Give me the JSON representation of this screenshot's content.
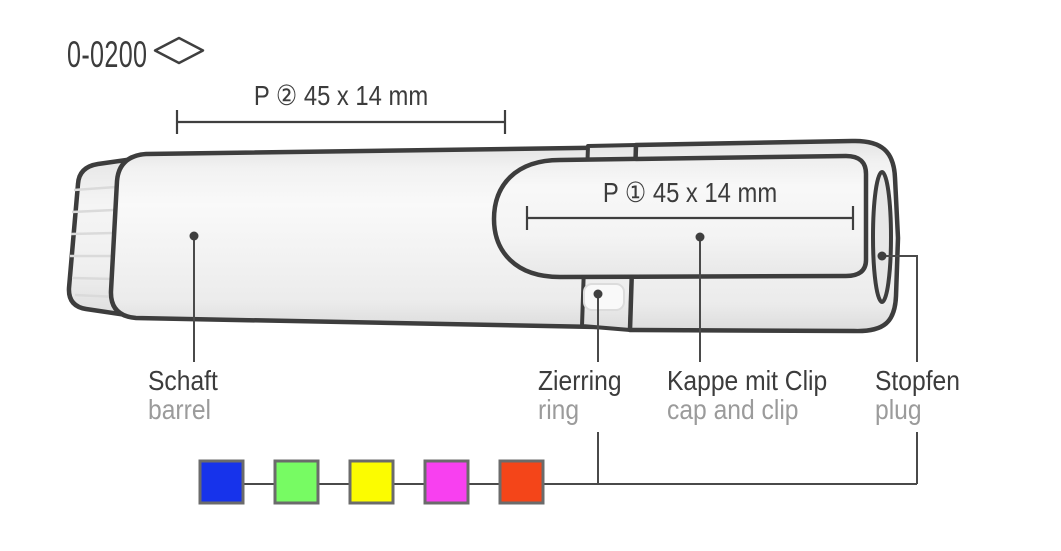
{
  "header": {
    "product_code": "0-0200",
    "shape_icon": "diamond-outline"
  },
  "print_areas": {
    "p2_label": "P ② 45 x 14 mm",
    "p1_label": "P ① 45 x 14 mm"
  },
  "parts": {
    "barrel": {
      "de": "Schaft",
      "en": "barrel"
    },
    "ring": {
      "de": "Zierring",
      "en": "ring"
    },
    "cap": {
      "de": "Kappe mit Clip",
      "en": "cap and clip"
    },
    "plug": {
      "de": "Stopfen",
      "en": "plug"
    }
  },
  "swatches": [
    {
      "name": "blue",
      "color": "#1733EB"
    },
    {
      "name": "green",
      "color": "#77FB63"
    },
    {
      "name": "yellow",
      "color": "#FCFC00"
    },
    {
      "name": "magenta",
      "color": "#F840F0"
    },
    {
      "name": "red",
      "color": "#F44519"
    }
  ],
  "style_colors": {
    "outline": "#3D3D3D",
    "leader_line": "#4A4A4A",
    "dimension_line": "#3F3F3F",
    "text_primary": "#3C3C3C",
    "text_secondary": "#9B9B9B",
    "swatch_border": "#6B6B6B",
    "body_fill_light": "#F7F7F7",
    "body_fill_dark": "#DEDEDE"
  }
}
